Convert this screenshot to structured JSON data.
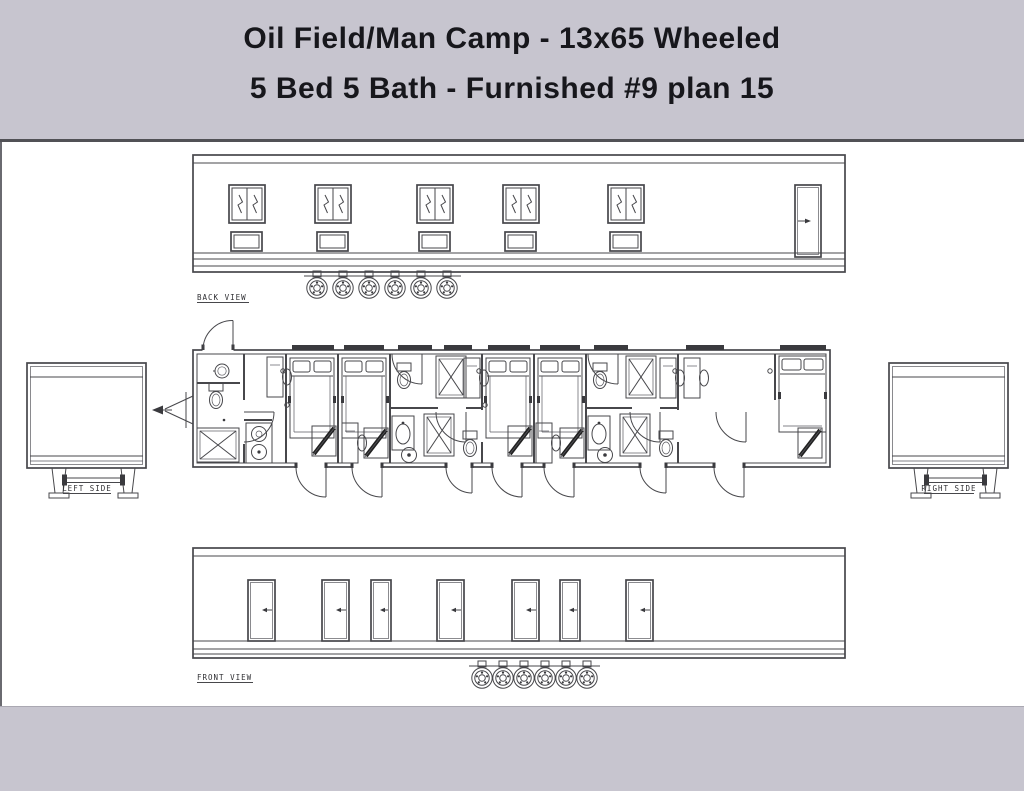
{
  "title": {
    "line1": "Oil Field/Man Camp - 13x65 Wheeled",
    "line2": "5 Bed 5 Bath - Furnished #9 plan 15"
  },
  "spec": {
    "size": "13x65",
    "mobility": "Wheeled",
    "beds": 5,
    "baths": 5,
    "furnished": true,
    "unit_number": "9",
    "plan_number": "15"
  },
  "views": {
    "back": {
      "label": "BACK VIEW",
      "windows": 5,
      "vents": 5,
      "doors": 1,
      "wheels": 6
    },
    "front": {
      "label": "FRONT VIEW",
      "doors": 7,
      "wheels": 6
    },
    "left": {
      "label": "LEFT SIDE"
    },
    "right": {
      "label": "RIGHT SIDE"
    },
    "plan": {
      "bedrooms": 5,
      "bathrooms": 5,
      "exterior_doors_bottom": 7,
      "exterior_doors_top": 1,
      "fixtures": [
        "bed",
        "desk-chair",
        "wardrobe",
        "shower",
        "toilet",
        "sink",
        "washer-dryer"
      ]
    }
  },
  "colors": {
    "band": "#c7c5cf",
    "paper": "#ffffff",
    "line": "#47474b",
    "title_text": "#17171c"
  }
}
